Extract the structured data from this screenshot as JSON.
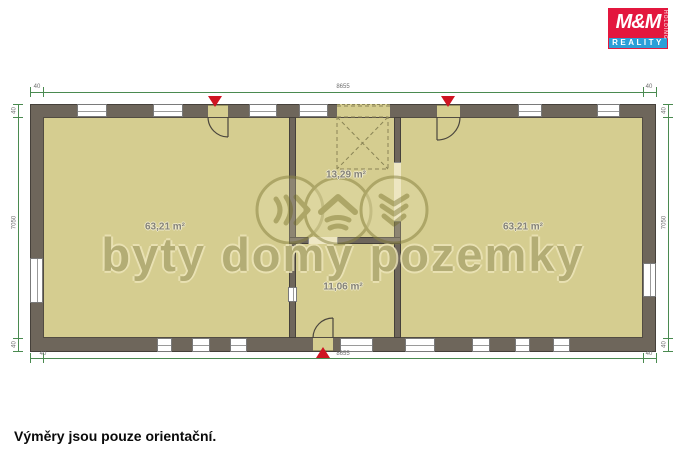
{
  "logo": {
    "mm": "M&M",
    "holding": "HOLDING",
    "reality": "REALITY"
  },
  "watermark": {
    "text": "byty domy pozemky",
    "icons": [
      "waves-right-icon",
      "house-icon",
      "chevrons-down-icon"
    ]
  },
  "rooms": {
    "left": {
      "label": "63,21 m²"
    },
    "hall": {
      "label": "13,29 m²"
    },
    "small": {
      "label": "11,06 m²"
    },
    "right": {
      "label": "63,21 m²"
    }
  },
  "dimensions": {
    "top_total": "8655",
    "bottom_total": "8655",
    "left_total": "7050",
    "right_total": "7050",
    "wall": "40"
  },
  "caption": "Výměry jsou pouze orientační.",
  "colors": {
    "wall": "#6e665b",
    "floor": "#d5cd90",
    "dimension_green": "#4a8a50",
    "entrance_red": "#cf1422",
    "logo_red": "#e3173e",
    "logo_blue": "#2b9fd8",
    "watermark_olive": "#8d8747"
  }
}
